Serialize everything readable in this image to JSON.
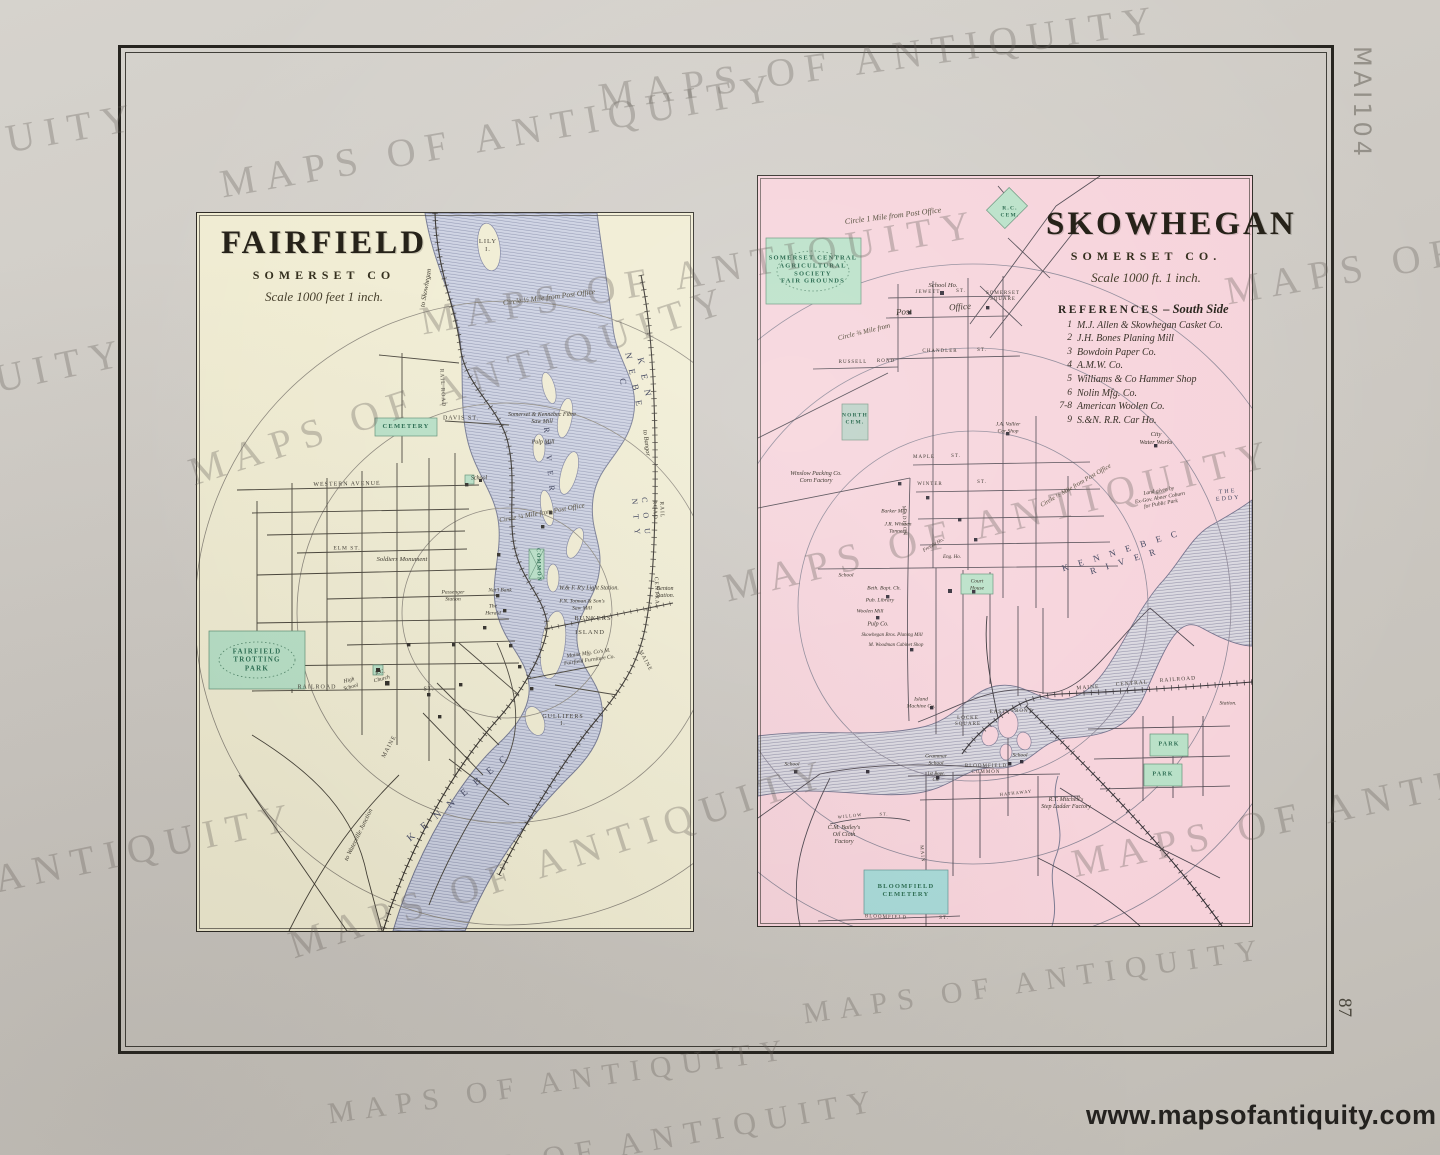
{
  "page": {
    "watermark_text": "MAPS OF ANTIQUITY",
    "url_watermark": "www.mapsofantiquity.com",
    "pencil_note": "MAI104",
    "page_number": "87",
    "colors": {
      "paper": "#cdc9c3",
      "fairfield_bg": "#f0ecd2",
      "skowhegan_bg": "#f6d2da",
      "river_base": "#ccd1e2",
      "river_line": "#8e94b0",
      "green": "#b7e0c6",
      "teal": "#a5d8d6",
      "ink": "#26241f"
    },
    "watermarks": [
      {
        "x": 880,
        "y": 58,
        "s": 40,
        "r": -8
      },
      {
        "x": 500,
        "y": 135,
        "s": 40,
        "r": -10
      },
      {
        "x": -140,
        "y": 165,
        "s": 40,
        "r": -10
      },
      {
        "x": 1505,
        "y": 242,
        "s": 40,
        "r": -10
      },
      {
        "x": 700,
        "y": 272,
        "s": 40,
        "r": -10
      },
      {
        "x": 460,
        "y": 385,
        "s": 40,
        "r": -18
      },
      {
        "x": -150,
        "y": 410,
        "s": 40,
        "r": -12
      },
      {
        "x": 1000,
        "y": 520,
        "s": 40,
        "r": -14
      },
      {
        "x": 560,
        "y": 858,
        "s": 40,
        "r": -18
      },
      {
        "x": 20,
        "y": 874,
        "s": 40,
        "r": -12
      },
      {
        "x": 1350,
        "y": 805,
        "s": 40,
        "r": -12
      },
      {
        "x": 1035,
        "y": 982,
        "s": 30,
        "r": -8
      },
      {
        "x": 560,
        "y": 1082,
        "s": 30,
        "r": -8
      },
      {
        "x": 640,
        "y": 1142,
        "s": 32,
        "r": -10
      }
    ]
  },
  "fairfield": {
    "title": "FAIRFIELD",
    "subtitle": "SOMERSET CO",
    "scale": "Scale 1000 feet 1 inch.",
    "labels": [
      {
        "t": "LILY\nI.",
        "x": 291,
        "y": 33,
        "r": 0,
        "s": 6.5,
        "c": "st"
      },
      {
        "t": "Circle ½ Mile from Post Office",
        "x": 352,
        "y": 84,
        "r": -7,
        "s": 7.5,
        "c": "circ"
      },
      {
        "t": "to Skowhegan",
        "x": 229,
        "y": 75,
        "r": -80,
        "s": 7,
        "c": "it"
      },
      {
        "t": "K E N N E B E C",
        "x": 437,
        "y": 168,
        "r": 78,
        "s": 9,
        "c": "riv"
      },
      {
        "t": "R I V E R",
        "x": 352,
        "y": 248,
        "r": 85,
        "s": 8,
        "c": "riv"
      },
      {
        "t": "CEMETERY",
        "x": 209,
        "y": 214,
        "r": 0,
        "s": 6.5,
        "c": "grn"
      },
      {
        "t": "DAVIS ST.",
        "x": 264,
        "y": 206,
        "r": 0,
        "s": 6,
        "c": "st"
      },
      {
        "t": "RAIL ROAD",
        "x": 245,
        "y": 175,
        "r": 87,
        "s": 5.5,
        "c": "st"
      },
      {
        "t": "Somerset & Kennebec Fibre\nSaw Mill",
        "x": 345,
        "y": 206,
        "r": 0,
        "s": 6,
        "c": "it"
      },
      {
        "t": "Pulp Mill",
        "x": 346,
        "y": 230,
        "r": 0,
        "s": 6,
        "c": "it"
      },
      {
        "t": "to Bangor",
        "x": 449,
        "y": 230,
        "r": 83,
        "s": 6.5,
        "c": "it"
      },
      {
        "t": "C O U N T Y",
        "x": 444,
        "y": 305,
        "r": 85,
        "s": 8,
        "c": "riv"
      },
      {
        "t": "RAIL ROAD",
        "x": 461,
        "y": 297,
        "r": 88,
        "s": 5.5,
        "c": "st"
      },
      {
        "t": "CENTRAL",
        "x": 459,
        "y": 380,
        "r": 88,
        "s": 5.5,
        "c": "st"
      },
      {
        "t": "MAINE",
        "x": 448,
        "y": 448,
        "r": 62,
        "s": 5.5,
        "c": "st"
      },
      {
        "t": "WESTERN  AVENUE",
        "x": 150,
        "y": 272,
        "r": -1,
        "s": 6,
        "c": "st"
      },
      {
        "t": "Circle ¼ Mile from Post Office",
        "x": 345,
        "y": 300,
        "r": -10,
        "s": 7,
        "c": "circ"
      },
      {
        "t": "School",
        "x": 282,
        "y": 266,
        "r": 0,
        "s": 6,
        "c": "it"
      },
      {
        "t": "ELM  ST.",
        "x": 150,
        "y": 336,
        "r": 0,
        "s": 5.5,
        "c": "st"
      },
      {
        "t": "Soldiers Monument",
        "x": 205,
        "y": 347,
        "r": 0,
        "s": 6.5,
        "c": "it"
      },
      {
        "t": "COMMON",
        "x": 341,
        "y": 352,
        "r": 88,
        "s": 5.5,
        "c": "grn"
      },
      {
        "t": "Passenger\nStation",
        "x": 256,
        "y": 383,
        "r": 0,
        "s": 5.5,
        "c": "it"
      },
      {
        "t": "Nat'l Bank",
        "x": 303,
        "y": 378,
        "r": 0,
        "s": 5.5,
        "c": "it"
      },
      {
        "t": "The\nHerald",
        "x": 296,
        "y": 397,
        "r": 0,
        "s": 5.5,
        "c": "it"
      },
      {
        "t": "W.& F. R'y Light Station.",
        "x": 392,
        "y": 376,
        "r": 0,
        "s": 6,
        "c": "it"
      },
      {
        "t": "F.N. Totman & Son's\nSaw Mill",
        "x": 385,
        "y": 392,
        "r": 0,
        "s": 5.5,
        "c": "it"
      },
      {
        "t": "BUNKERS",
        "x": 396,
        "y": 406,
        "r": 0,
        "s": 6.5,
        "c": "st"
      },
      {
        "t": "ISLAND",
        "x": 393,
        "y": 420,
        "r": 0,
        "s": 6.5,
        "c": "st"
      },
      {
        "t": "Maine Mfg. Co's M.\nFairfield Furniture Co.",
        "x": 392,
        "y": 444,
        "r": -8,
        "s": 5.5,
        "c": "it"
      },
      {
        "t": "Benton\nStation.",
        "x": 468,
        "y": 380,
        "r": 0,
        "s": 6,
        "c": "it"
      },
      {
        "t": "GULLIFERS\nI.",
        "x": 366,
        "y": 508,
        "r": 0,
        "s": 6,
        "c": "st"
      },
      {
        "t": "RAILROAD",
        "x": 120,
        "y": 475,
        "r": 0,
        "s": 6,
        "c": "st"
      },
      {
        "t": "ST.",
        "x": 232,
        "y": 477,
        "r": 0,
        "s": 6,
        "c": "st"
      },
      {
        "t": "FAIRFIELD\nTROTTING\nPARK",
        "x": 60,
        "y": 447,
        "r": 0,
        "s": 7,
        "c": "grn"
      },
      {
        "t": "High\nSchool",
        "x": 153,
        "y": 471,
        "r": -15,
        "s": 5.5,
        "c": "it"
      },
      {
        "t": "R.C.\nChurch",
        "x": 184,
        "y": 463,
        "r": -15,
        "s": 5.5,
        "c": "it"
      },
      {
        "t": "MAINE",
        "x": 193,
        "y": 534,
        "r": -62,
        "s": 6,
        "c": "st"
      },
      {
        "t": "K E N N E B E C",
        "x": 262,
        "y": 585,
        "r": -40,
        "s": 10,
        "c": "riv"
      },
      {
        "t": "to Waterville Junction",
        "x": 162,
        "y": 622,
        "r": -64,
        "s": 6.5,
        "c": "it"
      }
    ]
  },
  "skowhegan": {
    "title": "SKOWHEGAN",
    "subtitle": "SOMERSET CO.",
    "scale": "Scale 1000 ft. 1 inch.",
    "references_heading": "REFERENCES",
    "references_side": "– South Side",
    "references": [
      {
        "num": "1",
        "text": "M.J. Allen & Skowhegan Casket Co."
      },
      {
        "num": "2",
        "text": "J.H. Bones Planing Mill"
      },
      {
        "num": "3",
        "text": "Bowdoin Paper Co."
      },
      {
        "num": "4",
        "text": "A.M.W. Co."
      },
      {
        "num": "5",
        "text": "Williams & Co Hammer Shop"
      },
      {
        "num": "6",
        "text": "Nolin Mfg. Co."
      },
      {
        "num": "7-8",
        "text": "American Woolen Co."
      },
      {
        "num": "9",
        "text": "S.&N. R.R. Car Ho."
      }
    ],
    "labels": [
      {
        "t": "Circle 1 Mile from Post Office",
        "x": 135,
        "y": 40,
        "r": -7,
        "s": 8,
        "c": "circ"
      },
      {
        "t": "R.C.\nCEM.",
        "x": 252,
        "y": 36,
        "r": 0,
        "s": 5.5,
        "c": "grn"
      },
      {
        "t": "SOMERSET CENTRAL\nAGRICULTURAL\nSOCIETY\nFAIR GROUNDS",
        "x": 55,
        "y": 94,
        "r": 0,
        "s": 6.5,
        "c": "grn"
      },
      {
        "t": "School Ho.",
        "x": 185,
        "y": 110,
        "r": 0,
        "s": 6.5,
        "c": "it"
      },
      {
        "t": "SOMERSET\nSQUARE",
        "x": 245,
        "y": 121,
        "r": 0,
        "s": 5,
        "c": "st"
      },
      {
        "t": "JEWETT",
        "x": 170,
        "y": 117,
        "r": 0,
        "s": 5,
        "c": "st"
      },
      {
        "t": "ST.",
        "x": 203,
        "y": 116,
        "r": 0,
        "s": 5,
        "c": "st"
      },
      {
        "t": "Post",
        "x": 146,
        "y": 136,
        "r": -4,
        "s": 9,
        "c": "it"
      },
      {
        "t": "Office",
        "x": 202,
        "y": 131,
        "r": -4,
        "s": 9,
        "c": "it"
      },
      {
        "t": "Circle ¾ Mile from",
        "x": 106,
        "y": 156,
        "r": -14,
        "s": 7,
        "c": "circ"
      },
      {
        "t": "CHANDLER",
        "x": 182,
        "y": 176,
        "r": 0,
        "s": 5,
        "c": "st"
      },
      {
        "t": "ST.",
        "x": 224,
        "y": 175,
        "r": 0,
        "s": 5,
        "c": "st"
      },
      {
        "t": "RUSSELL",
        "x": 95,
        "y": 187,
        "r": 0,
        "s": 5,
        "c": "st"
      },
      {
        "t": "ROAD",
        "x": 128,
        "y": 186,
        "r": 0,
        "s": 5,
        "c": "st"
      },
      {
        "t": "NORTH\nCEM.",
        "x": 97,
        "y": 243,
        "r": 0,
        "s": 5.5,
        "c": "grn"
      },
      {
        "t": "Winslow Packing Co.\nCorn Factory",
        "x": 58,
        "y": 302,
        "r": 0,
        "s": 6,
        "c": "it"
      },
      {
        "t": "J.A. Vallier\nCar Shop",
        "x": 250,
        "y": 252,
        "r": 0,
        "s": 5.5,
        "c": "it"
      },
      {
        "t": "MAPLE",
        "x": 166,
        "y": 282,
        "r": 0,
        "s": 5,
        "c": "st"
      },
      {
        "t": "ST.",
        "x": 198,
        "y": 281,
        "r": 0,
        "s": 5,
        "c": "st"
      },
      {
        "t": "WINTER",
        "x": 172,
        "y": 309,
        "r": 0,
        "s": 5,
        "c": "st"
      },
      {
        "t": "ST.",
        "x": 224,
        "y": 307,
        "r": 0,
        "s": 5,
        "c": "st"
      },
      {
        "t": "MADISON",
        "x": 145,
        "y": 345,
        "r": 88,
        "s": 5,
        "c": "st"
      },
      {
        "t": "City\nWater Works",
        "x": 398,
        "y": 263,
        "r": 0,
        "s": 6.5,
        "c": "it"
      },
      {
        "t": "Circle ½ Mile from Post Office",
        "x": 318,
        "y": 310,
        "r": -30,
        "s": 6.5,
        "c": "circ"
      },
      {
        "t": "Land given by\nEx-Gov. Abner Coburn\nfor Public Park",
        "x": 402,
        "y": 322,
        "r": -10,
        "s": 5.5,
        "c": "it"
      },
      {
        "t": "THE EDDY",
        "x": 470,
        "y": 320,
        "r": -5,
        "s": 6,
        "c": "riv2"
      },
      {
        "t": "K E N N E B E C   R I V E R",
        "x": 365,
        "y": 380,
        "r": -17,
        "s": 9,
        "c": "riv"
      },
      {
        "t": "Barker Mill",
        "x": 136,
        "y": 336,
        "r": 0,
        "s": 5.5,
        "c": "it"
      },
      {
        "t": "J.R. Whitten\nTannery",
        "x": 140,
        "y": 352,
        "r": 0,
        "s": 5.5,
        "c": "it"
      },
      {
        "t": "School",
        "x": 88,
        "y": 400,
        "r": 0,
        "s": 5.5,
        "c": "it"
      },
      {
        "t": "Court\nHouse",
        "x": 219,
        "y": 409,
        "r": 0,
        "s": 5.5,
        "c": "it"
      },
      {
        "t": "Eng. Ho.",
        "x": 194,
        "y": 382,
        "r": 0,
        "s": 5,
        "c": "it"
      },
      {
        "t": "Freight Ho.",
        "x": 176,
        "y": 370,
        "r": -30,
        "s": 5,
        "c": "it"
      },
      {
        "t": "Beth. Bapt. Ch.",
        "x": 126,
        "y": 413,
        "r": 0,
        "s": 5.5,
        "c": "it"
      },
      {
        "t": "Pub. Library",
        "x": 122,
        "y": 425,
        "r": 0,
        "s": 5.5,
        "c": "it"
      },
      {
        "t": "Woolen Mill",
        "x": 112,
        "y": 436,
        "r": 0,
        "s": 5.5,
        "c": "it"
      },
      {
        "t": "Pulp Co.",
        "x": 120,
        "y": 449,
        "r": 0,
        "s": 6,
        "c": "it"
      },
      {
        "t": "Skowhegan Bros. Planing Mill",
        "x": 134,
        "y": 460,
        "r": 0,
        "s": 5,
        "c": "it"
      },
      {
        "t": "M. Woodman Cabinet Shop",
        "x": 138,
        "y": 470,
        "r": 0,
        "s": 5,
        "c": "it"
      },
      {
        "t": "Island\nMachine Co.",
        "x": 163,
        "y": 527,
        "r": 0,
        "s": 5.5,
        "c": "it"
      },
      {
        "t": "LOCKE\nSQUARE",
        "x": 210,
        "y": 546,
        "r": 0,
        "s": 5,
        "c": "st"
      },
      {
        "t": "EAST",
        "x": 240,
        "y": 537,
        "r": 0,
        "s": 5,
        "c": "st"
      },
      {
        "t": "FRONT",
        "x": 264,
        "y": 536,
        "r": 0,
        "s": 5,
        "c": "st"
      },
      {
        "t": "MAINE",
        "x": 330,
        "y": 512,
        "r": -4,
        "s": 5.5,
        "c": "st"
      },
      {
        "t": "CENTRAL",
        "x": 374,
        "y": 508,
        "r": -4,
        "s": 5.5,
        "c": "st"
      },
      {
        "t": "RAILROAD",
        "x": 420,
        "y": 504,
        "r": -4,
        "s": 5.5,
        "c": "st"
      },
      {
        "t": "Station.",
        "x": 470,
        "y": 528,
        "r": 0,
        "s": 5.5,
        "c": "it"
      },
      {
        "t": "PARK",
        "x": 411,
        "y": 569,
        "r": 0,
        "s": 6,
        "c": "grn"
      },
      {
        "t": "PARK",
        "x": 405,
        "y": 599,
        "r": 0,
        "s": 6,
        "c": "grn"
      },
      {
        "t": "School",
        "x": 262,
        "y": 580,
        "r": 0,
        "s": 5.5,
        "c": "it"
      },
      {
        "t": "Grammar\nSchool",
        "x": 178,
        "y": 584,
        "r": 0,
        "s": 5.5,
        "c": "it"
      },
      {
        "t": "1st Bapt.\nCh.",
        "x": 178,
        "y": 602,
        "r": 0,
        "s": 5,
        "c": "it"
      },
      {
        "t": "BLOOMFIELD\nCOMMON",
        "x": 228,
        "y": 594,
        "r": 0,
        "s": 5,
        "c": "st"
      },
      {
        "t": "HATHAWAY",
        "x": 258,
        "y": 617,
        "r": -6,
        "s": 4.5,
        "c": "st"
      },
      {
        "t": "School",
        "x": 34,
        "y": 589,
        "r": 0,
        "s": 5.5,
        "c": "it"
      },
      {
        "t": "R.T. Mitchell's\nStep Ladder Factory",
        "x": 308,
        "y": 628,
        "r": 0,
        "s": 6,
        "c": "it"
      },
      {
        "t": "C.M. Bailey's\nOil Cloth\nFactory",
        "x": 86,
        "y": 660,
        "r": 0,
        "s": 6,
        "c": "it"
      },
      {
        "t": "WILLOW",
        "x": 92,
        "y": 640,
        "r": -6,
        "s": 4.5,
        "c": "st"
      },
      {
        "t": "ST.",
        "x": 126,
        "y": 638,
        "r": 0,
        "s": 4.5,
        "c": "st"
      },
      {
        "t": "MAIN",
        "x": 163,
        "y": 678,
        "r": 85,
        "s": 5,
        "c": "st"
      },
      {
        "t": "BLOOMFIELD\nCEMETERY",
        "x": 148,
        "y": 715,
        "r": 0,
        "s": 6.5,
        "c": "grn"
      },
      {
        "t": "BLOOMFIELD",
        "x": 128,
        "y": 742,
        "r": 2,
        "s": 5,
        "c": "st"
      },
      {
        "t": "ST.",
        "x": 186,
        "y": 743,
        "r": 0,
        "s": 5,
        "c": "st"
      }
    ]
  }
}
